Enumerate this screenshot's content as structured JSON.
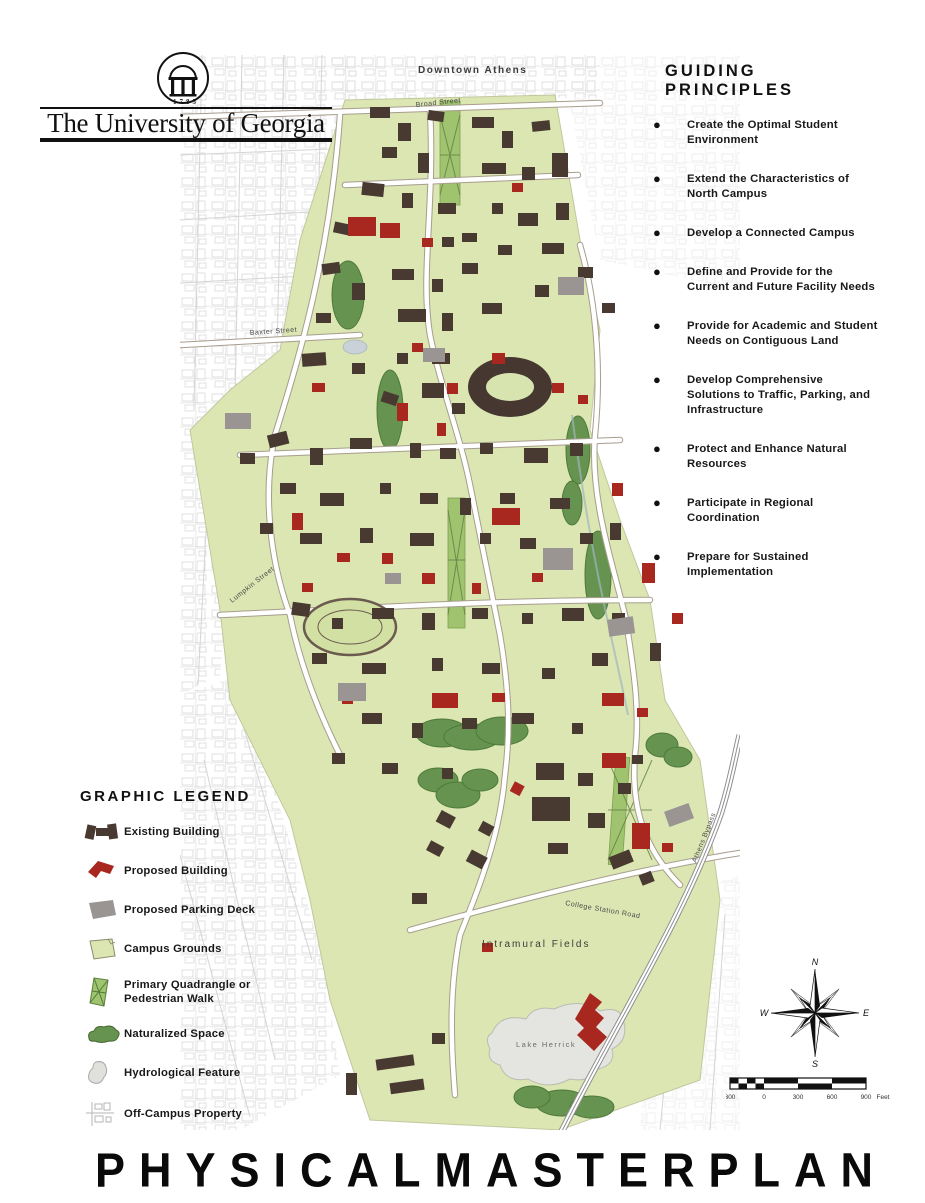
{
  "page": {
    "title": "PHYSICAL MASTER PLAN",
    "title_words": [
      "PHYSICAL",
      "MASTER",
      "PLAN"
    ]
  },
  "logo": {
    "institution": "The University of Georgia",
    "year": "1785"
  },
  "principles": {
    "heading": "GUIDING PRINCIPLES",
    "items": [
      "Create the Optimal Student Environment",
      "Extend the Characteristics of North Campus",
      "Develop a Connected Campus",
      "Define and Provide for the Current and Future Facility Needs",
      "Provide for Academic and Student Needs on Contiguous Land",
      "Develop Comprehensive Solutions to Traffic, Parking, and Infrastructure",
      "Protect and Enhance Natural Resources",
      "Participate in Regional Coordination",
      "Prepare for Sustained Implementation"
    ]
  },
  "legend": {
    "heading": "GRAPHIC LEGEND",
    "items": [
      {
        "label": "Existing Building",
        "swatch": "existing-building"
      },
      {
        "label": "Proposed Building",
        "swatch": "proposed-building"
      },
      {
        "label": "Proposed Parking Deck",
        "swatch": "proposed-parking-deck"
      },
      {
        "label": "Campus Grounds",
        "swatch": "campus-grounds"
      },
      {
        "label": "Primary Quadrangle or Pedestrian Walk",
        "swatch": "primary-quadrangle"
      },
      {
        "label": "Naturalized Space",
        "swatch": "naturalized-space"
      },
      {
        "label": "Hydrological Feature",
        "swatch": "hydrological-feature"
      },
      {
        "label": "Off-Campus Property",
        "swatch": "off-campus-property"
      }
    ]
  },
  "map_labels": {
    "downtown": "Downtown Athens",
    "broad_street": "Broad Street",
    "baxter_street": "Baxter Street",
    "lumpkin_street": "Lumpkin Street",
    "college_station_road": "College Station Road",
    "athens_bypass": "Athens Bypass",
    "intramural_fields": "Intramural Fields",
    "lake_herrick": "Lake Herrick"
  },
  "compass": {
    "n": "N",
    "e": "E",
    "s": "S",
    "w": "W"
  },
  "scale_bar": {
    "labels": [
      "300",
      "0",
      "300",
      "600",
      "900"
    ],
    "unit": "Feet"
  },
  "colors": {
    "existing_building": "#483931",
    "proposed_building": "#a8281f",
    "parking_deck": "#9a9492",
    "campus_grounds": "#dbe6b2",
    "quadrangle": "#9fc36e",
    "naturalized": "#679350",
    "hydrological": "#e4e4e0",
    "off_campus_line": "#cccccc"
  }
}
